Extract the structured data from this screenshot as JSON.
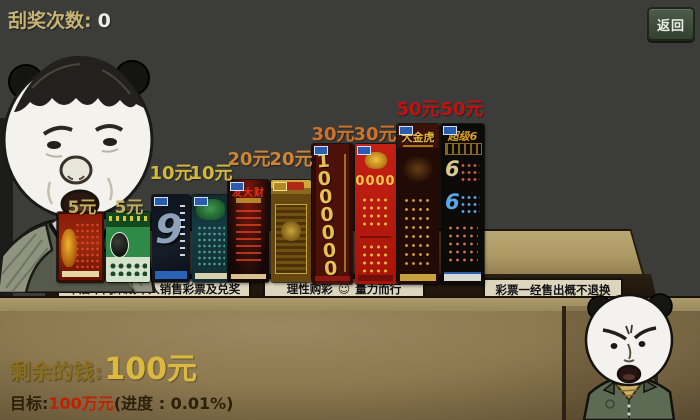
{
  "hud": {
    "scratch_label": "刮奖次数:",
    "scratch_value": "0",
    "back_button": "返回"
  },
  "signs": {
    "left": "本店不向未成年人销售彩票及兑奖",
    "middle_pre": "理性购彩",
    "middle_emoji": "☺",
    "middle_post": "量力而行",
    "right": "彩票一经售出概不退换"
  },
  "tickets": [
    {
      "price": "5元",
      "motif": ""
    },
    {
      "price": "5元",
      "motif": ""
    },
    {
      "price": "10元",
      "motif": "9"
    },
    {
      "price": "10元",
      "motif": ""
    },
    {
      "price": "20元",
      "motif": "发大财"
    },
    {
      "price": "20元",
      "motif": ""
    },
    {
      "price": "30元",
      "motif": "1000000"
    },
    {
      "price": "30元",
      "motif": "0000"
    },
    {
      "price": "50元",
      "motif": "大金虎"
    },
    {
      "price": "50元",
      "motif": "超级6",
      "digit": "6"
    }
  ],
  "footer": {
    "money_label": "剩余的钱:",
    "money_value": "100元",
    "goal_label": "目标:",
    "goal_value": "100万元",
    "progress_text": "(进度 : 0.01%)"
  },
  "colors": {
    "wall": "#3c3c3a",
    "counter_tan": "#ad9964",
    "price_tier_5": "#bfae5c",
    "price_tier_10": "#d2b83c",
    "price_tier_20": "#cf8531",
    "price_tier_30": "#cf7229",
    "price_tier_50": "#c01212",
    "money_gold": "#dcb93e",
    "goal_red": "#c02200",
    "back_button_green": "#3d4c39"
  }
}
